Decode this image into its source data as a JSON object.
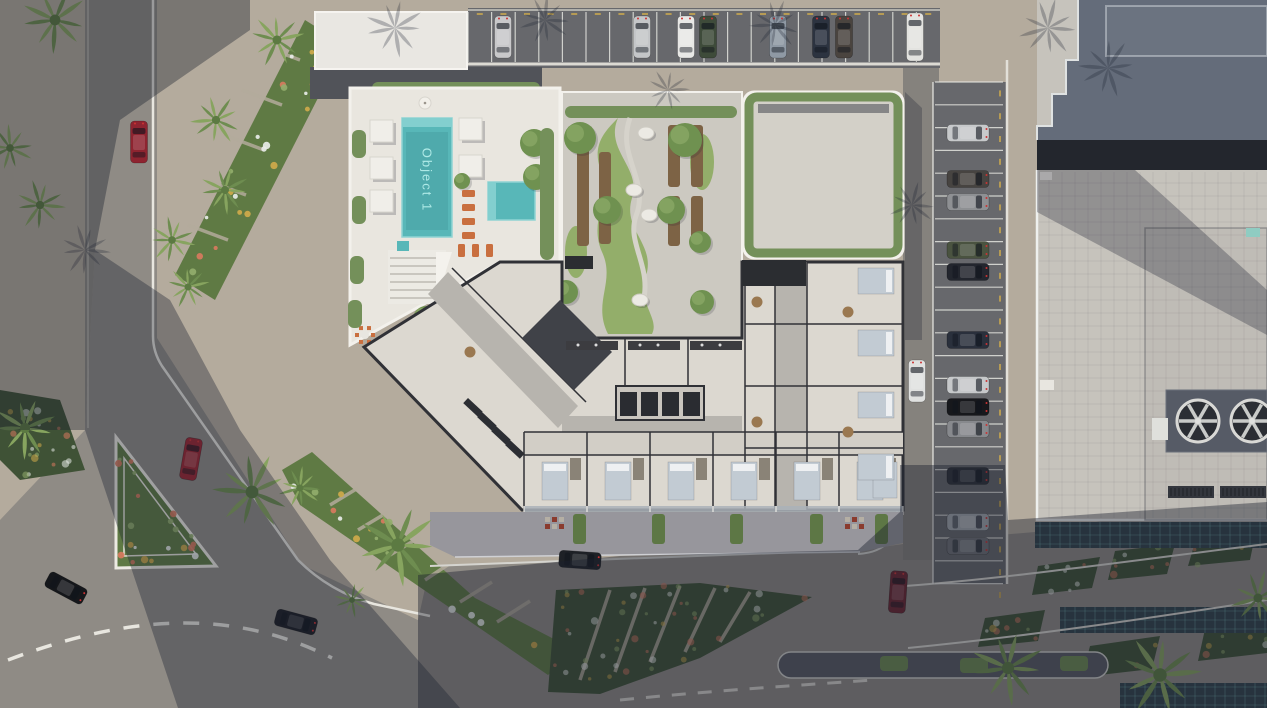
{
  "labels": {
    "pool": "Object 1"
  },
  "palette": {
    "pavement": "#b4ab9d",
    "asphalt": "#8f8b85",
    "asphalt_dark": "#67686c",
    "deck": "#e9e6df",
    "deck_edge": "#f3f1ec",
    "pool": "#58b7b8",
    "pool_steps": "#83cfcf",
    "pool_text": "#aee9e6",
    "grass": "#93ae6a",
    "bed_green": "#5f7a44",
    "bed_green_dark": "#3f5236",
    "tree": "#6f9150",
    "tree_light": "#8aa765",
    "hedge": "#74905a",
    "wood": "#7d6345",
    "floor": "#dcd8d0",
    "floor2": "#d2cec6",
    "corridor": "#b7b4ae",
    "wall": "#303136",
    "terrace": "#97969c",
    "roof_light": "#c6c3bc",
    "roof_dark": "#646c7a",
    "glass": "#31424a",
    "glass_line": "#7ec8be",
    "white_line": "#e8e6df",
    "lounger": "#c96f3f",
    "flower_colors": [
      "#e8ebe8",
      "#d8795e",
      "#cfa94b",
      "#93ad6d"
    ]
  },
  "top_parking": {
    "x": 468,
    "y": 8,
    "w": 472,
    "h": 58,
    "step": 23.6,
    "cars": [
      {
        "x": 503,
        "c": "#c8c8ca"
      },
      {
        "x": 642,
        "c": "#c4c6c8"
      },
      {
        "x": 686,
        "c": "#e8e8e6"
      },
      {
        "x": 708,
        "c": "#3e4b3a"
      },
      {
        "x": 778,
        "c": "#8f99a4"
      },
      {
        "x": 821,
        "c": "#2c3340"
      },
      {
        "x": 844,
        "c": "#4a443f"
      },
      {
        "x": 915,
        "c": "#e3e3e0",
        "van": true
      }
    ]
  },
  "right_parking": {
    "x": 933,
    "y": 82,
    "w": 74,
    "h": 502,
    "step": 22.8,
    "cars": [
      {
        "y": 133,
        "c": "#c7c9cb"
      },
      {
        "y": 179,
        "c": "#474441"
      },
      {
        "y": 202,
        "c": "#8e9093"
      },
      {
        "y": 250,
        "c": "#4a5340"
      },
      {
        "y": 272,
        "c": "#23262e"
      },
      {
        "y": 340,
        "c": "#2a303c"
      },
      {
        "y": 385,
        "c": "#c6c8ca"
      },
      {
        "y": 407,
        "c": "#17181c"
      },
      {
        "y": 429,
        "c": "#87898d"
      },
      {
        "y": 476,
        "c": "#2e3138"
      },
      {
        "y": 522,
        "c": "#a3a7ac"
      },
      {
        "y": 546,
        "c": "#6e7175"
      }
    ]
  },
  "road_cars": [
    {
      "x": 139,
      "y": 142,
      "r": 0,
      "c": "#8e2430"
    },
    {
      "x": 191,
      "y": 459,
      "r": 10,
      "c": "#9c2731"
    },
    {
      "x": 66,
      "y": 588,
      "r": 118,
      "c": "#15171b"
    },
    {
      "x": 296,
      "y": 622,
      "r": 105,
      "c": "#1d1f24"
    },
    {
      "x": 580,
      "y": 560,
      "r": 94,
      "c": "#1e2126"
    },
    {
      "x": 898,
      "y": 592,
      "r": 4,
      "c": "#6b2530"
    },
    {
      "x": 917,
      "y": 381,
      "r": 0,
      "c": "#e0e1e0"
    }
  ],
  "palms": [
    [
      55,
      20,
      34
    ],
    [
      10,
      148,
      24
    ],
    [
      40,
      205,
      26
    ],
    [
      277,
      40,
      28
    ],
    [
      216,
      120,
      26
    ],
    [
      225,
      190,
      25
    ],
    [
      172,
      240,
      24
    ],
    [
      188,
      287,
      22
    ],
    [
      25,
      428,
      32
    ],
    [
      252,
      492,
      40
    ],
    [
      300,
      488,
      22
    ],
    [
      398,
      545,
      42
    ],
    [
      352,
      600,
      18
    ],
    [
      1008,
      668,
      38
    ],
    [
      1160,
      675,
      42
    ],
    [
      1258,
      598,
      28
    ]
  ],
  "palm_shadows": [
    [
      395,
      28,
      30
    ],
    [
      545,
      20,
      26
    ],
    [
      775,
      25,
      26
    ],
    [
      1048,
      28,
      30
    ],
    [
      1108,
      68,
      30
    ],
    [
      668,
      90,
      22
    ],
    [
      912,
      205,
      24
    ],
    [
      85,
      250,
      26
    ]
  ],
  "flower_beds": [
    {
      "pts": "305,20 345,45 215,300 175,275",
      "dark": false,
      "hatch": [
        [
          300,
          60,
          260,
          45
        ],
        [
          282,
          105,
          242,
          90
        ],
        [
          264,
          150,
          224,
          135
        ],
        [
          246,
          195,
          206,
          180
        ],
        [
          228,
          240,
          188,
          225
        ]
      ]
    },
    {
      "pts": "282,470 312,452 475,598 575,650 548,675 300,505",
      "dark": false,
      "hatch": [
        [
          330,
          505,
          358,
          488
        ],
        [
          358,
          530,
          388,
          512
        ],
        [
          390,
          555,
          420,
          537
        ],
        [
          425,
          580,
          455,
          560
        ],
        [
          460,
          602,
          492,
          582
        ],
        [
          497,
          622,
          530,
          601
        ]
      ]
    },
    {
      "pts": "116,437 216,566 116,568",
      "dark": false,
      "island": true
    },
    {
      "pts": "548,692 556,590 700,583 812,597 700,658 600,694",
      "dark": true,
      "hatch": [
        [
          580,
          680,
          610,
          590
        ],
        [
          615,
          672,
          645,
          588
        ],
        [
          650,
          662,
          680,
          586
        ],
        [
          685,
          652,
          715,
          588
        ],
        [
          720,
          642,
          750,
          592
        ]
      ]
    },
    {
      "pts": "1038,566 1100,557 1092,588 1032,595",
      "dark": true
    },
    {
      "pts": "1115,551 1175,544 1167,574 1108,580",
      "dark": true
    },
    {
      "pts": "1196,539 1256,531 1250,560 1188,566",
      "dark": true
    },
    {
      "pts": "985,618 1045,610 1038,641 978,647",
      "dark": true
    },
    {
      "pts": "1090,646 1160,636 1152,669 1082,677",
      "dark": true
    },
    {
      "pts": "1205,629 1267,619 1267,653 1198,661",
      "dark": true
    },
    {
      "pts": "0,390 60,400 85,470 20,480 0,460",
      "dark": true
    }
  ],
  "deck": {
    "cabanas": [
      [
        370,
        120
      ],
      [
        370,
        157
      ],
      [
        370,
        190
      ],
      [
        459,
        118
      ],
      [
        459,
        155
      ]
    ],
    "trees": [
      [
        462,
        181,
        8
      ],
      [
        534,
        143,
        14
      ],
      [
        536,
        177,
        13
      ],
      [
        426,
        319,
        13
      ],
      [
        393,
        345,
        15
      ],
      [
        412,
        380,
        12
      ]
    ],
    "loungers_col": {
      "x": 462,
      "ys": [
        190,
        204,
        218,
        232
      ]
    },
    "loungers_row": {
      "y": 244,
      "xs": [
        458,
        472,
        486
      ]
    },
    "cafe": [
      [
        365,
        335
      ],
      [
        444,
        340
      ]
    ],
    "hedges": [
      [
        352,
        130
      ],
      [
        352,
        196
      ],
      [
        350,
        256
      ],
      [
        348,
        300
      ]
    ]
  },
  "garden": {
    "planters": [
      [
        577,
        148,
        12,
        98
      ],
      [
        599,
        152,
        12,
        92
      ],
      [
        668,
        125,
        12,
        62
      ],
      [
        691,
        125,
        12,
        62
      ],
      [
        668,
        196,
        12,
        50
      ],
      [
        691,
        196,
        12,
        50
      ]
    ],
    "trees": [
      [
        580,
        138,
        16
      ],
      [
        685,
        140,
        17
      ],
      [
        607,
        210,
        14
      ],
      [
        671,
        210,
        14
      ],
      [
        700,
        242,
        11
      ],
      [
        566,
        292,
        12
      ],
      [
        702,
        302,
        12
      ]
    ],
    "stones": [
      [
        646,
        133
      ],
      [
        634,
        190
      ],
      [
        649,
        215
      ],
      [
        640,
        300
      ]
    ]
  },
  "floorplan": {
    "bedrooms_x": [
      524,
      587,
      650,
      713,
      776,
      839
    ],
    "bed_extra_x": [
      871
    ],
    "wing_beds_y": [
      268,
      330,
      392,
      454
    ],
    "kitchens_x": [
      566,
      628,
      690
    ],
    "gym": [
      [
        468,
        398
      ],
      [
        482,
        412
      ],
      [
        496,
        426
      ],
      [
        510,
        440
      ]
    ],
    "tables": [
      [
        757,
        302
      ],
      [
        757,
        422
      ],
      [
        848,
        312
      ],
      [
        848,
        432
      ],
      [
        470,
        352
      ]
    ],
    "core_x": [
      620,
      641,
      662,
      683
    ]
  },
  "terrace": {
    "planters": [
      [
        573,
        514
      ],
      [
        652,
        514
      ],
      [
        730,
        514
      ],
      [
        810,
        514
      ],
      [
        875,
        514
      ]
    ],
    "tables": [
      [
        545,
        517
      ],
      [
        845,
        517
      ]
    ]
  },
  "median": {
    "grass": [
      [
        880,
        656
      ],
      [
        960,
        658
      ],
      [
        1060,
        656
      ]
    ]
  },
  "glass_bands": [
    [
      1035,
      522,
      232,
      26
    ],
    [
      1060,
      607,
      207,
      26
    ],
    [
      1120,
      683,
      147,
      25
    ]
  ],
  "fans": [
    [
      1198,
      421
    ],
    [
      1252,
      421
    ]
  ],
  "vents": [
    [
      1168,
      486
    ],
    [
      1220,
      486
    ]
  ]
}
